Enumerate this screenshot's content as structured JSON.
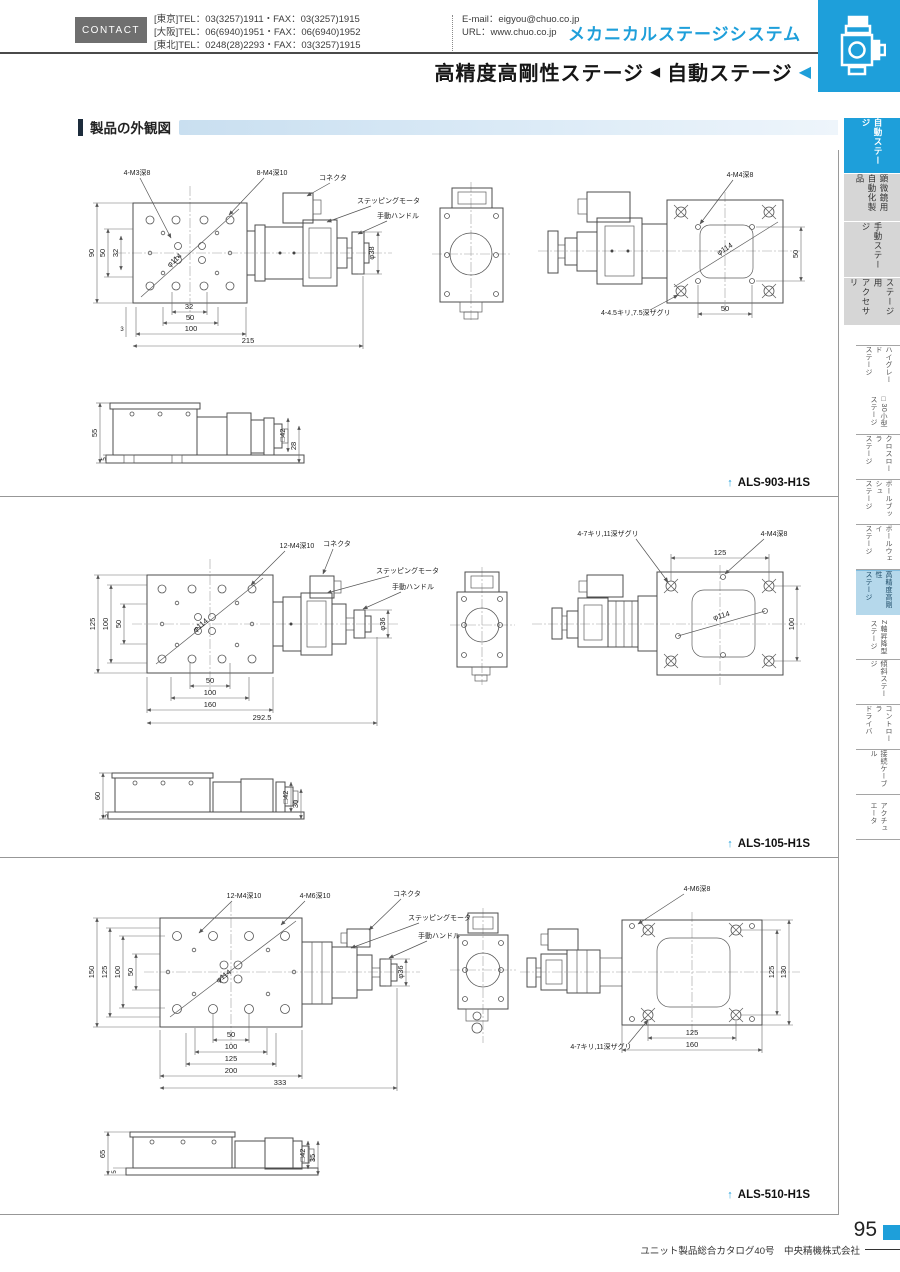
{
  "header": {
    "contact_label": "CONTACT",
    "tel_lines": "[東京]TEL：03(3257)1911・FAX：03(3257)1915\n[大阪]TEL：06(6940)1951・FAX：06(6940)1952\n[東北]TEL：0248(28)2293・FAX：03(3257)1915",
    "email": "E-mail：eigyou@chuo.co.jp",
    "url": "URL：www.chuo.co.jp",
    "brand": "メカニカルステージシステム",
    "page_title": {
      "left": "高精度高剛性ステージ",
      "sep": "◀",
      "right": "自動ステージ",
      "arrow": "◀"
    }
  },
  "section_title": "製品の外観図",
  "sidebar": {
    "main_tabs": [
      {
        "label": "自動ステージ",
        "active": true
      },
      {
        "label": "顕微鏡用\n自動化製品",
        "active": false
      },
      {
        "label": "手動ステージ",
        "active": false
      },
      {
        "label": "ステージ用\nアクセサリ",
        "active": false
      }
    ],
    "sub_tabs": [
      {
        "label": "ハイグレード\nステージ",
        "active": false
      },
      {
        "label": "□30小型\nステージ",
        "active": false
      },
      {
        "label": "クロスローラ\nステージ",
        "active": false
      },
      {
        "label": "ボールブッシュ\nステージ",
        "active": false
      },
      {
        "label": "ボールウェイ\nステージ",
        "active": false
      },
      {
        "label": "高精度高剛性\nステージ",
        "active": true
      },
      {
        "label": "Z軸昇降型\nステージ",
        "active": false
      },
      {
        "label": "傾斜ステージ",
        "active": false
      },
      {
        "label": "コントローラ\nドライバ",
        "active": false
      },
      {
        "label": "接続ケーブル",
        "active": false
      },
      {
        "label": "アクチュ\nエータ",
        "active": false
      }
    ]
  },
  "drawings": [
    {
      "model": "ALS-903-H1S",
      "arrow": "↑",
      "ann": {
        "tap1": "4-M3深8",
        "tap2": "8-M4深10",
        "connector": "コネクタ",
        "motor": "ステッピングモータ",
        "handle": "手動ハンドル",
        "dia_table": "φ114",
        "dia_table2": "φ114",
        "dia_knob": "φ38",
        "bottom_tap": "4-M4深8",
        "counterbore": "4-4.5キリ,7.5深ザグリ"
      },
      "dims": {
        "left": [
          "90",
          "50",
          "32"
        ],
        "bottom": [
          "32",
          "50",
          "100",
          "215"
        ],
        "offset": "3",
        "bv_right": "50",
        "bv_bottom": "50",
        "side": [
          "55",
          "5",
          "□42",
          "28"
        ]
      }
    },
    {
      "model": "ALS-105-H1S",
      "arrow": "↑",
      "ann": {
        "tap1": "12-M4深10",
        "connector": "コネクタ",
        "motor": "ステッピングモータ",
        "handle": "手動ハンドル",
        "dia_table": "φ114",
        "dia_table2": "φ114",
        "dia_knob": "φ36",
        "bottom_tap": "4-M4深8",
        "counterbore": "4-7キリ,11深ザグリ"
      },
      "dims": {
        "left": [
          "125",
          "100",
          "50"
        ],
        "bottom": [
          "50",
          "100",
          "160",
          "292.5"
        ],
        "bv_top": "125",
        "bv_right": "100",
        "side": [
          "60",
          "5",
          "□42",
          "30"
        ]
      }
    },
    {
      "model": "ALS-510-H1S",
      "arrow": "↑",
      "ann": {
        "tap1": "12-M4深10",
        "tap2": "4-M6深10",
        "connector": "コネクタ",
        "motor": "ステッピングモータ",
        "handle": "手動ハンドル",
        "dia_table": "φ114",
        "dia_knob": "φ36",
        "bottom_tap": "4-M6深8",
        "counterbore": "4-7キリ,11深ザグリ"
      },
      "dims": {
        "left": [
          "150",
          "125",
          "100",
          "50"
        ],
        "bottom": [
          "50",
          "100",
          "125",
          "200",
          "333"
        ],
        "bv_right": [
          "125",
          "130"
        ],
        "bv_bottom": [
          "125",
          "160"
        ],
        "side": [
          "65",
          "5",
          "□42",
          "35"
        ]
      }
    }
  ],
  "footer": {
    "page_number": "95",
    "catalog_note": "ユニット製品総合カタログ40号　中央精機株式会社"
  }
}
